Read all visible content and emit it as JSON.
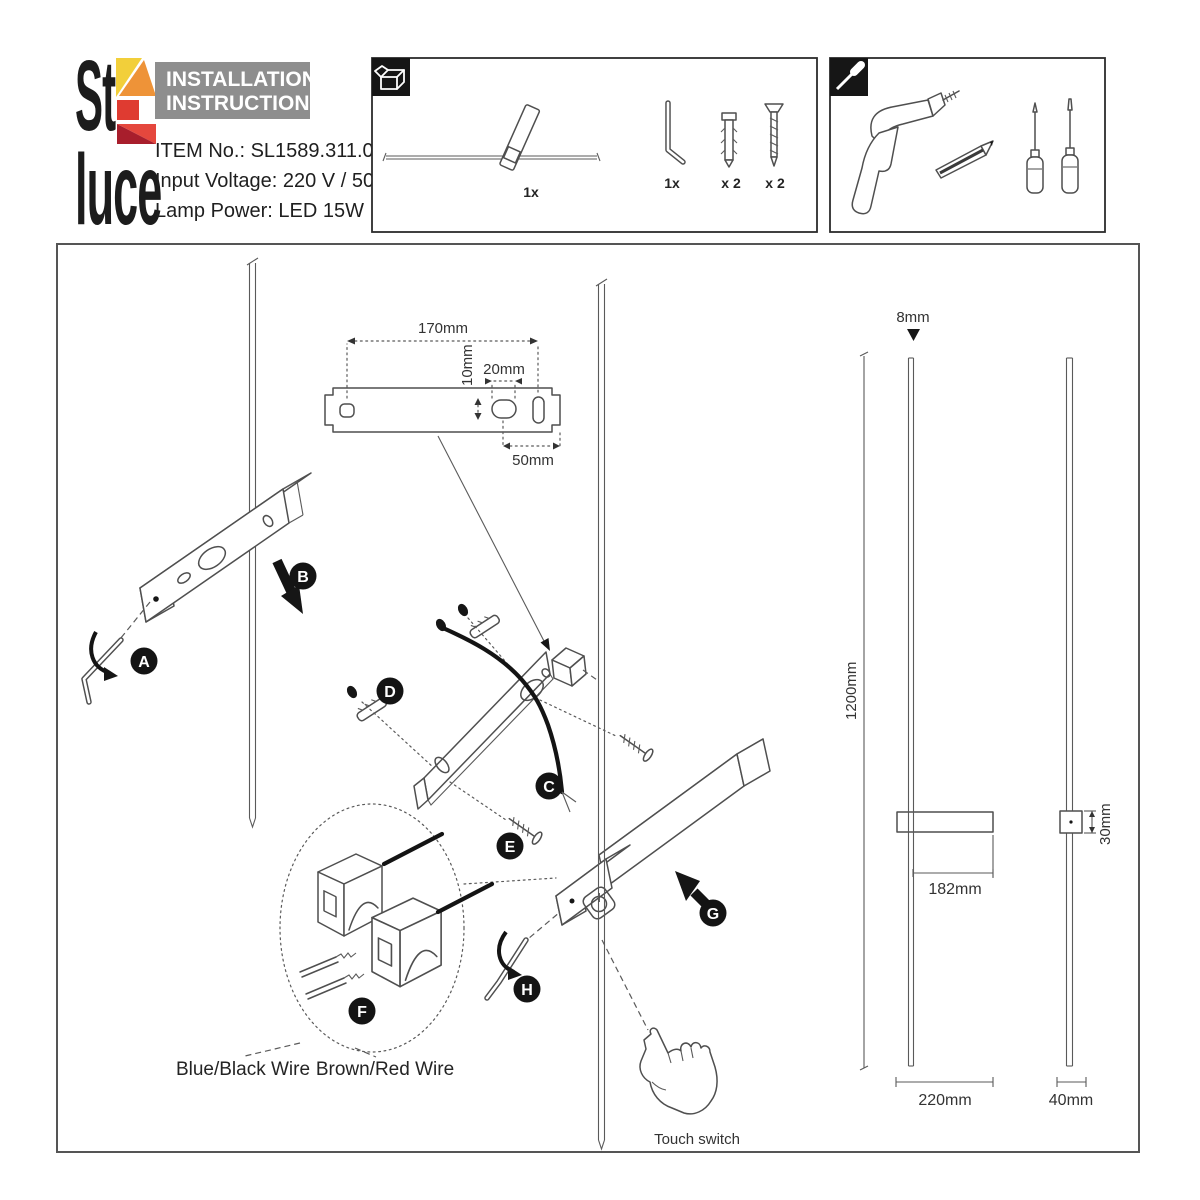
{
  "header": {
    "logo_top": "St",
    "logo_bottom": "luce",
    "title1": "INSTALLATION",
    "title2": "INSTRUCTIONS",
    "item_no": "ITEM No.: SL1589.311.01",
    "input_voltage": "Input Voltage: 220 V / 50Hz",
    "lamp_power": "Lamp Power: LED 15W"
  },
  "package": {
    "lamp_qty": "1x",
    "key_qty": "1x",
    "anchor_qty": "x 2",
    "screw_qty": "x 2"
  },
  "bracket": {
    "total_width": "170mm",
    "hole_height": "10mm",
    "slot_width": "20mm",
    "end_offset": "50mm"
  },
  "steps": [
    "A",
    "B",
    "C",
    "D",
    "E",
    "F",
    "G",
    "H"
  ],
  "wires": {
    "left": "Blue/Black Wire",
    "right": "Brown/Red Wire"
  },
  "touch_switch": "Touch switch",
  "dims": {
    "diameter": "8mm",
    "height": "1200mm",
    "arm": "182mm",
    "depth": "30mm",
    "width": "220mm",
    "side": "40mm"
  },
  "colors": {
    "header_gray": "#8e8e8e",
    "yellow": "#f2cf3a",
    "orange": "#ee9338",
    "red": "#df3b31",
    "red_bright": "#e5473d",
    "red_dark": "#a81e2c"
  }
}
